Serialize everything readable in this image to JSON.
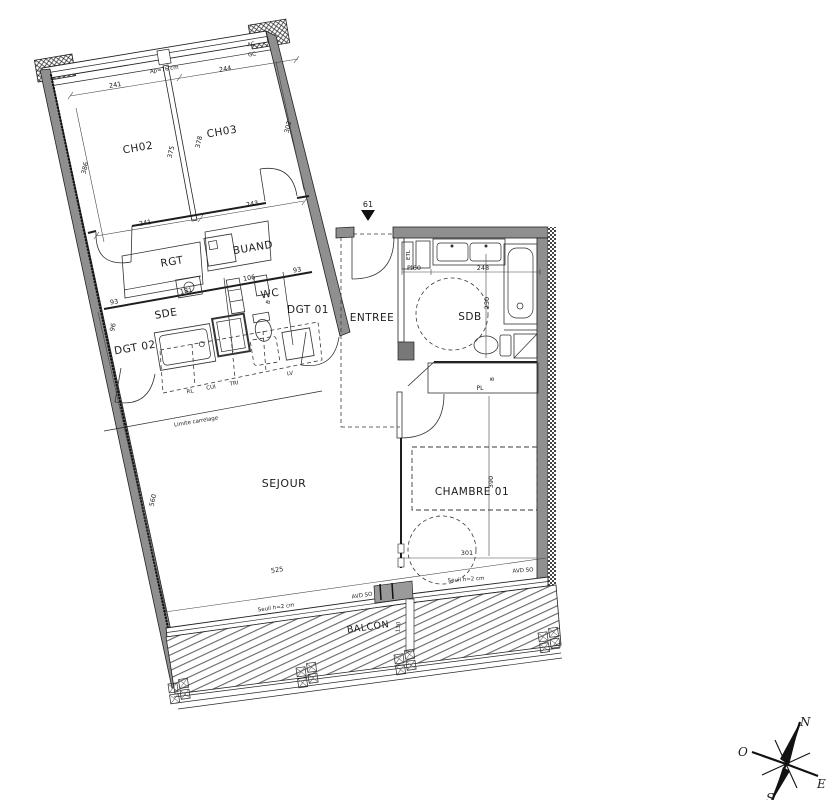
{
  "rooms": {
    "ch02": "CH02",
    "ch03": "CH03",
    "rgt": "RGT",
    "buand": "BUAND",
    "sde": "SDE",
    "wc": "WC",
    "dgt01": "DGT 01",
    "dgt02": "DGT 02",
    "entree": "ENTREE",
    "sdb": "SDB",
    "sejour": "SEJOUR",
    "chambre01": "CHAMBRE 01",
    "balcon": "BALCON"
  },
  "dims": {
    "ch02_width_top": "241",
    "ch03_width_top": "244",
    "ch02_height": "386",
    "ch02_depth": "375",
    "ch03_depth": "378",
    "ch03_height": "302",
    "ch02_width_bottom": "241",
    "ch03_width_bottom": "243",
    "sde_left": "93",
    "sde_width": "181",
    "wc_width": "106",
    "dgt01_width": "93",
    "dgt02_height": "96",
    "door_number": "61",
    "sdb_placard": "Pl60",
    "sdb_width": "248",
    "sdb_depth": "250",
    "chambre_width": "301",
    "chambre_depth": "390",
    "sejour_width": "525",
    "sejour_depth": "560",
    "balcon_depth": "130"
  },
  "annotations": {
    "window_sill": "Ap=76 cm",
    "duct_ac": "AC",
    "duct_gc": "GC",
    "cabinet_etl": "ETL",
    "wc_b": "B",
    "closet_pl": "PL",
    "closet_b": "B",
    "kitchen_rl": "RL",
    "kitchen_cui": "CUI",
    "kitchen_tri": "TRI",
    "kitchen_lv": "LV",
    "tile_limit": "Limite carrelage",
    "seuil_sejour": "Seuil h=2 cm",
    "seuil_chambre": "Seuil h=2 cm",
    "avd_sejour": "AVD SO",
    "avd_chambre": "AVD SO"
  },
  "compass": {
    "north": "N",
    "south": "S",
    "east": "E",
    "west": "O"
  },
  "colors": {
    "wall_fill": "#8f8f8f",
    "line": "#1c1c1c",
    "threshold": "#9a9a9a"
  }
}
